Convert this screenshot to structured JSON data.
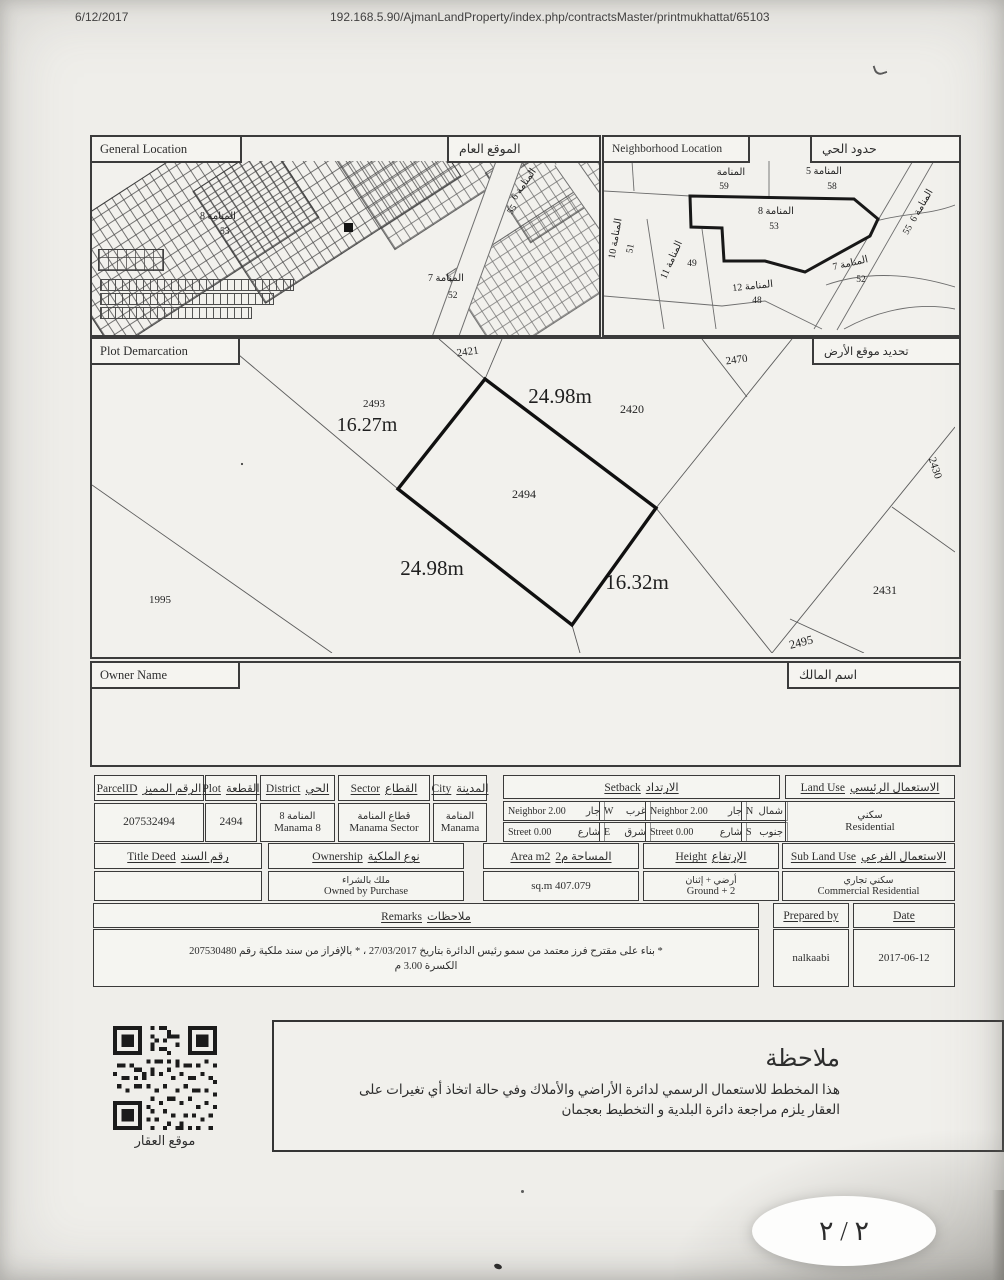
{
  "page": {
    "print_date": "6/12/2017",
    "print_url": "192.168.5.90/AjmanLandProperty/index.php/contractsMaster/printmukhattat/65103",
    "page_number": "٢ / ٢"
  },
  "boxes": {
    "general_location": {
      "en": "General Location",
      "ar": "الموقع العام",
      "labels": {
        "d8": "المنامة 8",
        "d8n": "53",
        "d7": "المنامة 7",
        "d7n": "52",
        "d6": "المنامة 6",
        "d6n": "55"
      }
    },
    "neighborhood": {
      "en": "Neighborhood Location",
      "ar": "حدود الحي",
      "areas": [
        {
          "name": "المنامة",
          "num": "59"
        },
        {
          "name": "المنامة 5",
          "num": "58"
        },
        {
          "name": "المنامة 8",
          "num": "53"
        },
        {
          "name": "المنامة 6",
          "num": "55"
        },
        {
          "name": "المنامة 7",
          "num": "52"
        },
        {
          "name": "المنامة 12",
          "num": "48"
        },
        {
          "name": "المنامة 11",
          "num": "49"
        },
        {
          "name": "المنامة 10",
          "num": "51"
        }
      ]
    },
    "plot_demarcation": {
      "en": "Plot Demarcation",
      "ar": "تحديد موقع الأرض",
      "plot_number": "2494",
      "dim_top": "24.98m",
      "dim_left": "16.27m",
      "dim_bottom": "24.98m",
      "dim_right": "16.32m",
      "adjacent": {
        "p2421": "2421",
        "p2470": "2470",
        "p2493": "2493",
        "p2420": "2420",
        "p1995": "1995",
        "p2431": "2431",
        "p2495": "2495",
        "p2430": "2430"
      }
    },
    "owner": {
      "en": "Owner Name",
      "ar": "اسم المالك",
      "value": ""
    }
  },
  "table": {
    "parcel_id": {
      "en": "ParcelID",
      "ar": "الرقم المميز",
      "value": "207532494"
    },
    "plot": {
      "en": "Plot",
      "ar": "القطعة",
      "value": "2494"
    },
    "district": {
      "en": "District",
      "ar": "الحي",
      "value_ar": "المنامة 8",
      "value_en": "Manama 8"
    },
    "sector": {
      "en": "Sector",
      "ar": "القطاع",
      "value_ar": "قطاع المنامة",
      "value_en": "Manama Sector"
    },
    "city": {
      "en": "City",
      "ar": "المدينة",
      "value_ar": "المنامة",
      "value_en": "Manama"
    },
    "setback": {
      "en": "Setback",
      "ar": "الارتداد",
      "cells": [
        {
          "en": "Neighbor 2.00",
          "ar": "جار",
          "dir_en": "W",
          "dir_ar": "غرب"
        },
        {
          "en": "Neighbor 2.00",
          "ar": "جار",
          "dir_en": "N",
          "dir_ar": "شمال"
        },
        {
          "en": "Street 0.00",
          "ar": "شارع",
          "dir_en": "E",
          "dir_ar": "شرق"
        },
        {
          "en": "Street 0.00",
          "ar": "شارع",
          "dir_en": "S",
          "dir_ar": "جنوب"
        }
      ]
    },
    "land_use": {
      "en": "Land Use",
      "ar": "الاستعمال الرئيسي",
      "value_ar": "سكني",
      "value_en": "Residential"
    },
    "title_deed": {
      "en": "Title Deed",
      "ar": "رقم السند",
      "value": ""
    },
    "ownership": {
      "en": "Ownership",
      "ar": "نوع الملكية",
      "value_ar": "ملك بالشراء",
      "value_en": "Owned by Purchase"
    },
    "area": {
      "en": "Area m2",
      "ar": "المساحة م2",
      "value": "sq.m 407.079"
    },
    "height": {
      "en": "Height",
      "ar": "الإرتفاع",
      "value_ar": "أرضي + إثنان",
      "value_en": "Ground + 2"
    },
    "sub_land_use": {
      "en": "Sub Land Use",
      "ar": "الاستعمال الفرعي",
      "value_ar": "سكني تجاري",
      "value_en": "Commercial Residential"
    },
    "remarks": {
      "en": "Remarks",
      "ar": "ملاحظات",
      "line1": "* بناء على مقترح فرز معتمد من سمو رئيس الدائرة بتاريخ 27/03/2017 ، * بالإفراز من سند ملكية رقم 207530480",
      "line2": "الكسرة 3.00 م"
    },
    "prepared_by": {
      "label": "Prepared by",
      "value": "nalkaabi"
    },
    "date": {
      "label": "Date",
      "value": "2017-06-12"
    }
  },
  "footer": {
    "note_title": "ملاحظة",
    "note_body": "هذا المخطط للاستعمال الرسمي لدائرة الأراضي والأملاك وفي حالة اتخاذ أي تغيرات على العقار يلزم مراجعة دائرة البلدية و التخطيط بعجمان",
    "qr_caption": "موقع العقار"
  }
}
